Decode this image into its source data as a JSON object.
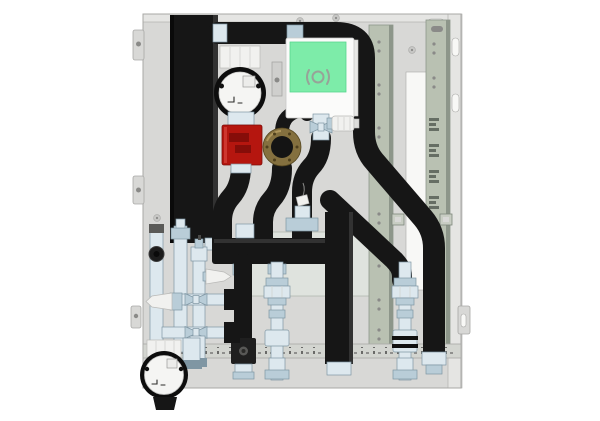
{
  "canvas": {
    "width": 600,
    "height": 421
  },
  "scene_type": "3d-product-render",
  "colors": {
    "background": "#ffffff",
    "panel": "#d8d8d6",
    "panel_light": "#e5e5e3",
    "panel_edge": "#a8a8a6",
    "plate": "#dfe3de",
    "plate_edge": "#b2b8b0",
    "rail": "#b9c1b2",
    "rail_edge": "#8d968a",
    "rail_bottom": "#d3d5d0",
    "slot_white": "#f8f8f6",
    "hole_gray": "#8a8a88",
    "screw": "#c7c7c5",
    "insulation": "#161616",
    "insulation_hi": "#323232",
    "insulation_lo": "#0a0a0a",
    "chrome_light": "#dde8ee",
    "chrome_mid": "#b9cdd8",
    "chrome_dark": "#7f96a3",
    "pump_face": "#f5f5f3",
    "pump_ring": "#0d0d0d",
    "plastic_white": "#f1f1ef",
    "valve_red": "#b5160f",
    "valve_red_dark": "#7e0c08",
    "controller_green": "#7deca9",
    "controller_green_edge": "#57d68f",
    "controller_body": "#fbfbfa",
    "brass": "#84703f",
    "brass_dark": "#55461f",
    "logo_gray": "#97a398"
  },
  "components": [
    "back-panel",
    "panel-mounting-tab",
    "panel-slot",
    "panel-cutout",
    "panel-screw",
    "mounting-plate",
    "mounting-rail-left",
    "mounting-rail-right",
    "rail-hook-slot",
    "rail-clip",
    "bottom-mounting-rail",
    "insulated-duct",
    "insulated-supply-pipe",
    "insulated-pipe-diagonal",
    "insulated-manifold",
    "manifold-fitting",
    "cable-tag",
    "circulation-pump-top",
    "circulation-pump-bottom",
    "pump-display-window",
    "balancing-valve-red",
    "pump-volute-brass",
    "controller-unit",
    "controller-cover-green",
    "brand-logo-icon",
    "zone-valve-actuator",
    "air-vent",
    "safety-valve",
    "drain-knob",
    "service-valve-left",
    "service-valve-right",
    "pipe-bracket",
    "pipe-union",
    "pump-foot"
  ]
}
